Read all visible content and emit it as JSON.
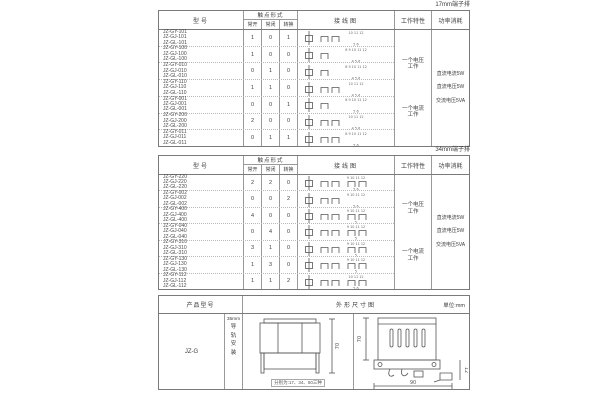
{
  "page": {
    "background": "#ffffff",
    "text_color": "#3d3d3d",
    "border_color": "#7a7a7a"
  },
  "table_17mm": {
    "corner_label": "17mm端子排",
    "headers": {
      "model": "型号",
      "contact_form": "触点形式",
      "no": "常开",
      "nc": "常闭",
      "co": "转换",
      "diagram": "接线图",
      "work": "工作特性",
      "power": "功率消耗"
    },
    "work_items": [
      "一个电压工作",
      "一个电流工作"
    ],
    "power_items": [
      "直流电流5W",
      "直流电压5W",
      "交流电压5VA"
    ],
    "rows": [
      {
        "models": [
          "JZ-GY-101",
          "JZ-GJ-101",
          "JZ-GL-101"
        ],
        "no": "1",
        "nc": "0",
        "co": "1",
        "terminals_top": "10 11 12",
        "terminals_bottom": "5 6"
      },
      {
        "models": [
          "JZ-GY-100",
          "JZ-GJ-100",
          "JZ-GL-100"
        ],
        "no": "1",
        "nc": "0",
        "co": "0",
        "terminals_top": "8 9 10 11 12",
        "terminals_bottom": "4 5 6"
      },
      {
        "models": [
          "JZ-GY-010",
          "JZ-GJ-010",
          "JZ-GL-010"
        ],
        "no": "0",
        "nc": "1",
        "co": "0",
        "terminals_top": "8 9 10 11 12",
        "terminals_bottom": "4 5 6"
      },
      {
        "models": [
          "JZ-GY-110",
          "JZ-GJ-110",
          "JZ-GL-110"
        ],
        "no": "1",
        "nc": "1",
        "co": "0",
        "terminals_top": "10 11 12",
        "terminals_bottom": "4 5 6"
      },
      {
        "models": [
          "JZ-GY-001",
          "JZ-GJ-001",
          "JZ-GL-001"
        ],
        "no": "0",
        "nc": "0",
        "co": "1",
        "terminals_top": "8 9 10 11 12",
        "terminals_bottom": "5 6"
      },
      {
        "models": [
          "JZ-GY-200",
          "JZ-GJ-200",
          "JZ-GL-200"
        ],
        "no": "2",
        "nc": "0",
        "co": "0",
        "terminals_top": "10 11 12",
        "terminals_bottom": "4 5 6"
      },
      {
        "models": [
          "JZ-GY-011",
          "JZ-GJ-011",
          "JZ-GL-011"
        ],
        "no": "0",
        "nc": "1",
        "co": "1",
        "terminals_top": "8 9 10 11 12",
        "terminals_bottom": "5 6"
      }
    ]
  },
  "table_34mm": {
    "corner_label": "34mm端子排",
    "headers": {
      "model": "型号",
      "contact_form": "触点形式",
      "no": "常开",
      "nc": "常闭",
      "co": "转换",
      "diagram": "接线图",
      "work": "工作特性",
      "power": "功率消耗"
    },
    "work_items": [
      "一个电压工作",
      "一个电流工作"
    ],
    "power_items": [
      "直流电流5W",
      "直流电压5W",
      "交流电压5VA"
    ],
    "rows": [
      {
        "models": [
          "JZ-GY-220",
          "JZ-GJ-220",
          "JZ-GL-220"
        ],
        "no": "2",
        "nc": "2",
        "co": "0",
        "terminals_top": "9 10 11 12",
        "terminals_bottom": "5 6"
      },
      {
        "models": [
          "JZ-GY-002",
          "JZ-GJ-002",
          "JZ-GL-002"
        ],
        "no": "0",
        "nc": "0",
        "co": "2",
        "terminals_top": "9 10 11 12",
        "terminals_bottom": "5 6"
      },
      {
        "models": [
          "JZ-GY-400",
          "JZ-GJ-400",
          "JZ-GL-400"
        ],
        "no": "4",
        "nc": "0",
        "co": "0",
        "terminals_top": "9 10 11 12",
        "terminals_bottom": "5"
      },
      {
        "models": [
          "JZ-GY-040",
          "JZ-GJ-040",
          "JZ-GL-040"
        ],
        "no": "0",
        "nc": "4",
        "co": "0",
        "terminals_top": "9 10 11 12",
        "terminals_bottom": "5"
      },
      {
        "models": [
          "JZ-GY-310",
          "JZ-GJ-310",
          "JZ-GL-310"
        ],
        "no": "3",
        "nc": "1",
        "co": "0",
        "terminals_top": "9 10 11 12",
        "terminals_bottom": "5"
      },
      {
        "models": [
          "JZ-GY-130",
          "JZ-GJ-130",
          "JZ-GL-130"
        ],
        "no": "1",
        "nc": "3",
        "co": "0",
        "terminals_top": "9 10 11 12",
        "terminals_bottom": "5"
      },
      {
        "models": [
          "JZ-GY-112",
          "JZ-GJ-112",
          "JZ-GL-112"
        ],
        "no": "1",
        "nc": "1",
        "co": "2",
        "terminals_top": "10 11 12",
        "terminals_bottom": "5 6"
      }
    ]
  },
  "bottom_table": {
    "headers": {
      "product_model": "产品型号",
      "outline": "外形尺寸图",
      "unit": "单位:mm"
    },
    "model": "JZ-G",
    "mount_top": "35mm",
    "mount_vertical": "导轨安装",
    "front_view": {
      "height_dim": "70",
      "caption": "分别为:17、34、60三种"
    },
    "side_view": {
      "height_dim": "70",
      "width_dim": "90",
      "rail_dim": "12"
    }
  }
}
